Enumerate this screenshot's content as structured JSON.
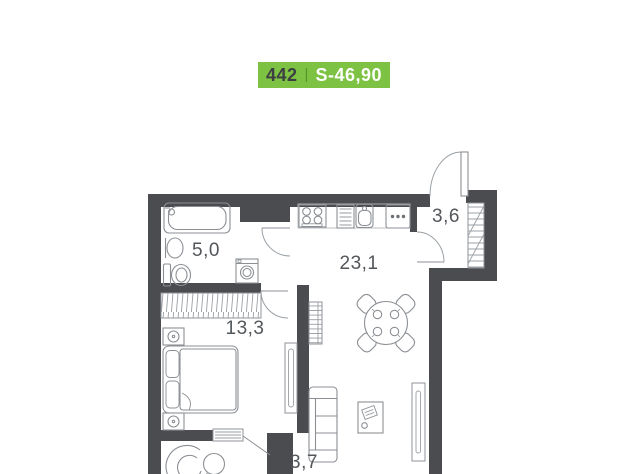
{
  "badge": {
    "unit_number": "442",
    "separator": "|",
    "area_label": "S-46,90",
    "background_color": "#7dc242",
    "number_color": "#3c4043",
    "area_color": "#ffffff"
  },
  "floor_plan": {
    "wall_color": "#4a4c4f",
    "line_color": "#8f9398",
    "label_color": "#53565a",
    "rooms": [
      {
        "name": "bathroom",
        "area": "5,0"
      },
      {
        "name": "hallway",
        "area": "3,6"
      },
      {
        "name": "kitchen-living-room",
        "area": "23,1"
      },
      {
        "name": "bedroom",
        "area": "13,3"
      },
      {
        "name": "wc",
        "area": "3,7"
      }
    ],
    "fixtures": [
      "bathtub",
      "washbasin",
      "toilet",
      "washing-machine",
      "stove",
      "dish-rack",
      "kitchen-sink",
      "kitchen-cabinet",
      "built-in-wardrobe",
      "hallway-wardrobe",
      "bookshelf",
      "dining-table",
      "chairs",
      "sofa",
      "coffee-table",
      "tv-console",
      "double-bed",
      "nightstand",
      "radiator",
      "wc-sink",
      "entrance-door",
      "interior-doors"
    ]
  }
}
